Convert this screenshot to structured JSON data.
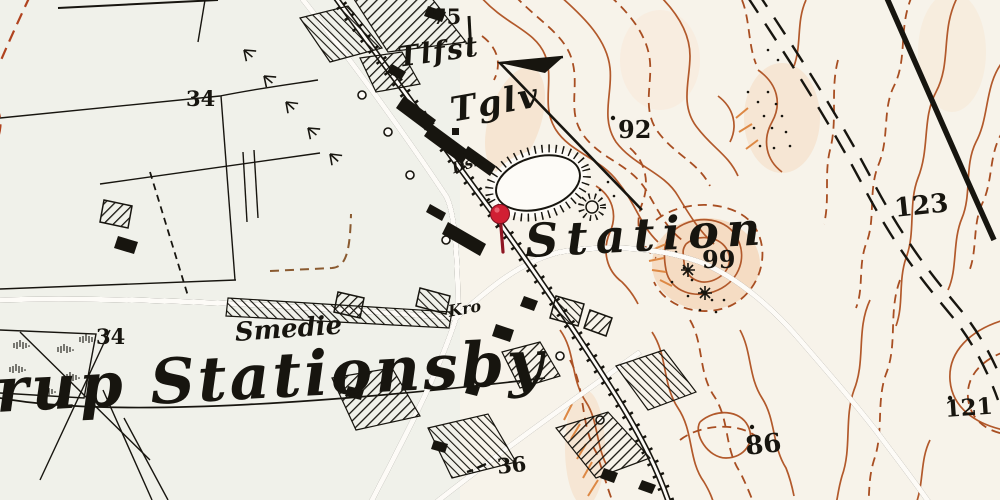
{
  "map": {
    "palette": {
      "paper": "#f7f3ea",
      "field_tint": "#e9efe9",
      "contour": "#b2592b",
      "contour_dashed": "#a84e22",
      "slope_hachure": "#dd8844",
      "ink": "#17150f",
      "boundary_red": "#b0431f",
      "path_brown": "#8a5a30",
      "pin_red": "#d11f33",
      "terrain_wash": "#f4cda8"
    },
    "marker": {
      "icon": "map-pin-icon",
      "color": "#d11f33"
    },
    "labels": [
      {
        "id": "spot-height-75",
        "text": "75"
      },
      {
        "id": "abbr-tlfst",
        "text": "Tlfst"
      },
      {
        "id": "abbr-tglv",
        "text": "Tglv"
      },
      {
        "id": "spot-height-92",
        "text": "92"
      },
      {
        "id": "spot-height-123",
        "text": "123"
      },
      {
        "id": "abbr-dsk",
        "text": "Dsk"
      },
      {
        "id": "place-station",
        "text": "Station"
      },
      {
        "id": "spot-height-99",
        "text": "99"
      },
      {
        "id": "abbr-kro",
        "text": "Kro"
      },
      {
        "id": "place-smedie",
        "text": "Smedie"
      },
      {
        "id": "parcel-34-west",
        "text": "34"
      },
      {
        "id": "parcel-34-north",
        "text": "34"
      },
      {
        "id": "place-rup-stationsby",
        "text": "rup Stationsby"
      },
      {
        "id": "spot-height-121",
        "text": "121"
      },
      {
        "id": "spot-height-86",
        "text": "86"
      },
      {
        "id": "spot-height-36",
        "text": "36"
      }
    ]
  }
}
